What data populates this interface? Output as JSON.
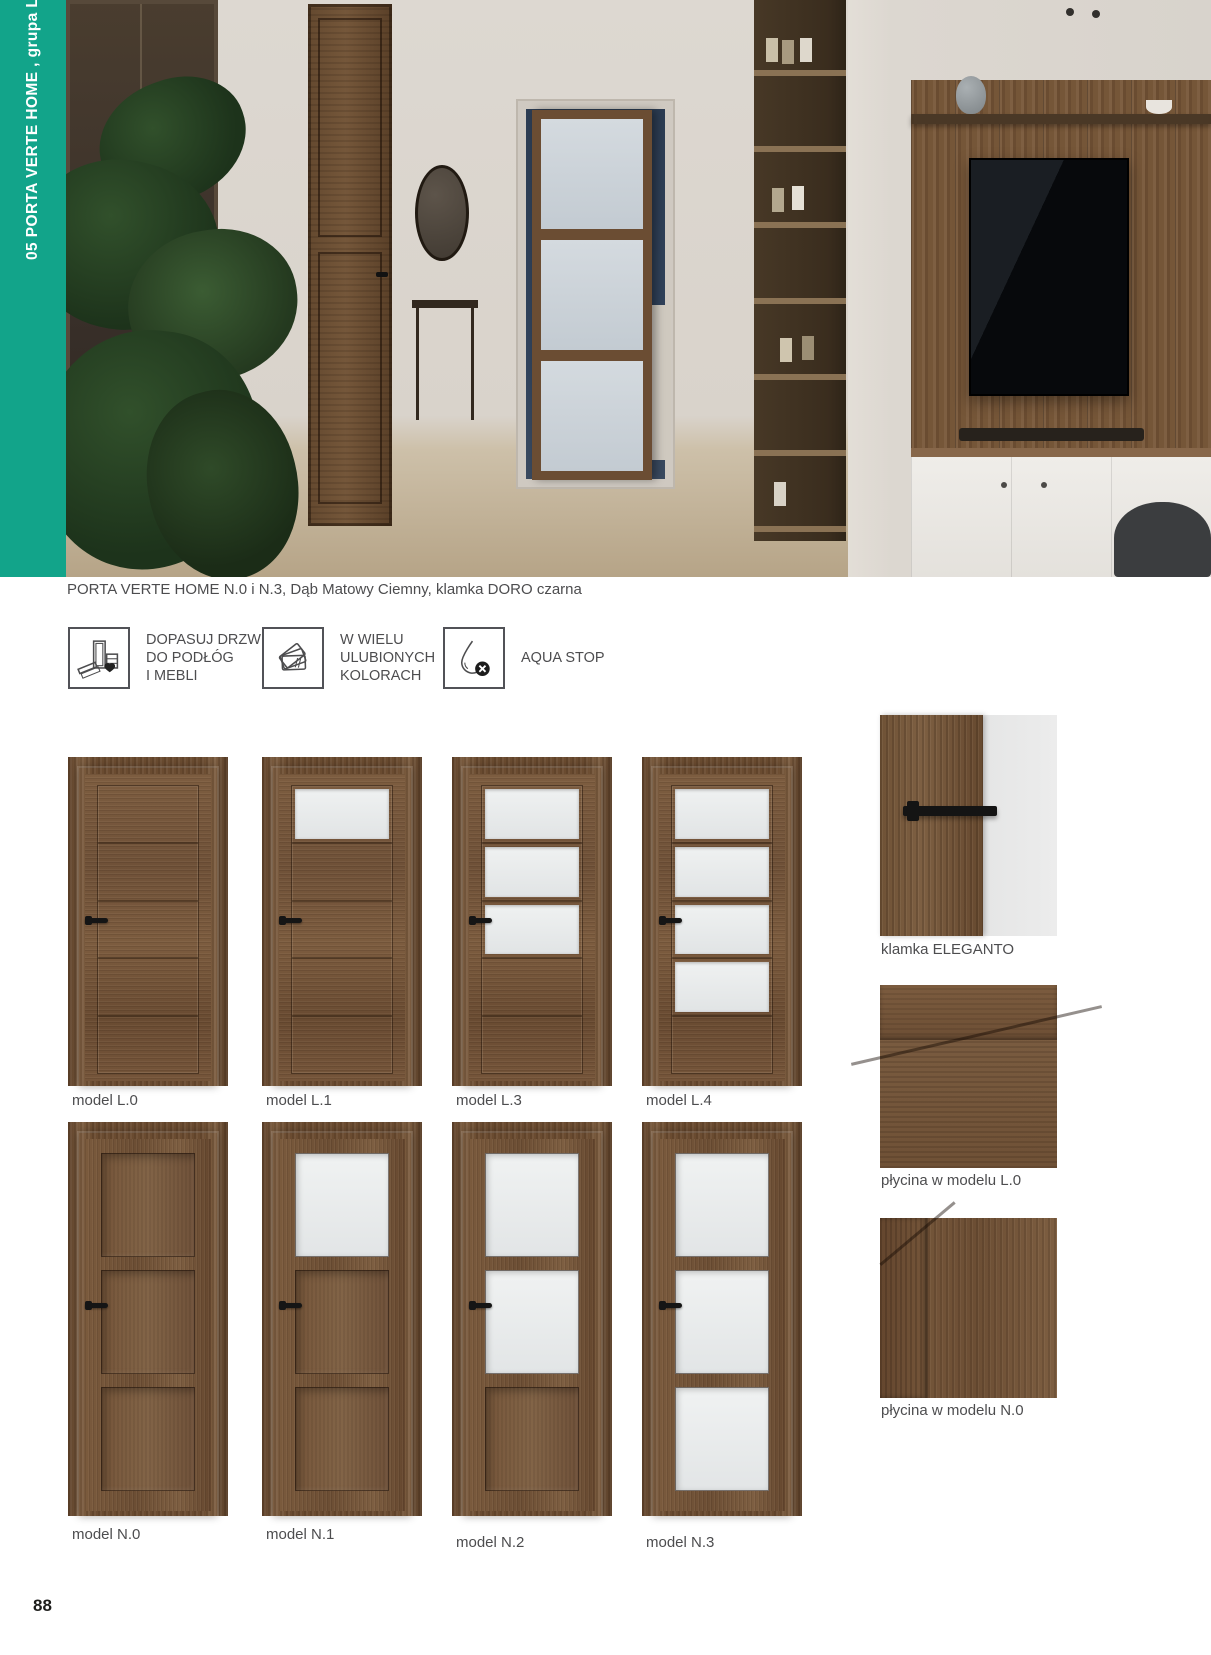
{
  "sidebar": {
    "label": "05  PORTA VERTE HOME , grupa L i N",
    "accent_color": "#12a48a"
  },
  "hero": {
    "caption": "PORTA VERTE HOME N.0 i N.3, Dąb Matowy Ciemny, klamka DORO czarna"
  },
  "features": [
    {
      "icon": "door-and-furniture-heart-icon",
      "label": "DOPASUJ DRZWI\nDO PODŁÓG\nI MEBLI"
    },
    {
      "icon": "color-swatches-icon",
      "label": "W WIELU\nULUBIONYCH\nKOLORACH"
    },
    {
      "icon": "water-drop-stop-icon",
      "label": "AQUA STOP"
    }
  ],
  "models": {
    "row1": [
      {
        "label": "model L.0",
        "series": "L",
        "glass": 0
      },
      {
        "label": "model L.1",
        "series": "L",
        "glass": 1
      },
      {
        "label": "model L.3",
        "series": "L",
        "glass": 3
      },
      {
        "label": "model L.4",
        "series": "L",
        "glass": 4
      }
    ],
    "row2": [
      {
        "label": "model N.0",
        "series": "N",
        "glass": 0
      },
      {
        "label": "model N.1",
        "series": "N",
        "glass": 1
      },
      {
        "label": "model N.2",
        "series": "N",
        "glass": 2
      },
      {
        "label": "model N.3",
        "series": "N",
        "glass": 3
      }
    ]
  },
  "details": [
    {
      "label": "klamka ELEGANTO"
    },
    {
      "label": "płycina w modelu L.0"
    },
    {
      "label": "płycina w modelu N.0"
    }
  ],
  "page": {
    "number": "88"
  },
  "colors": {
    "wood_dark": "#6a4c33",
    "wood_mid": "#7b5c40",
    "glass": "#e9ecec",
    "text": "#4d4d4f"
  }
}
